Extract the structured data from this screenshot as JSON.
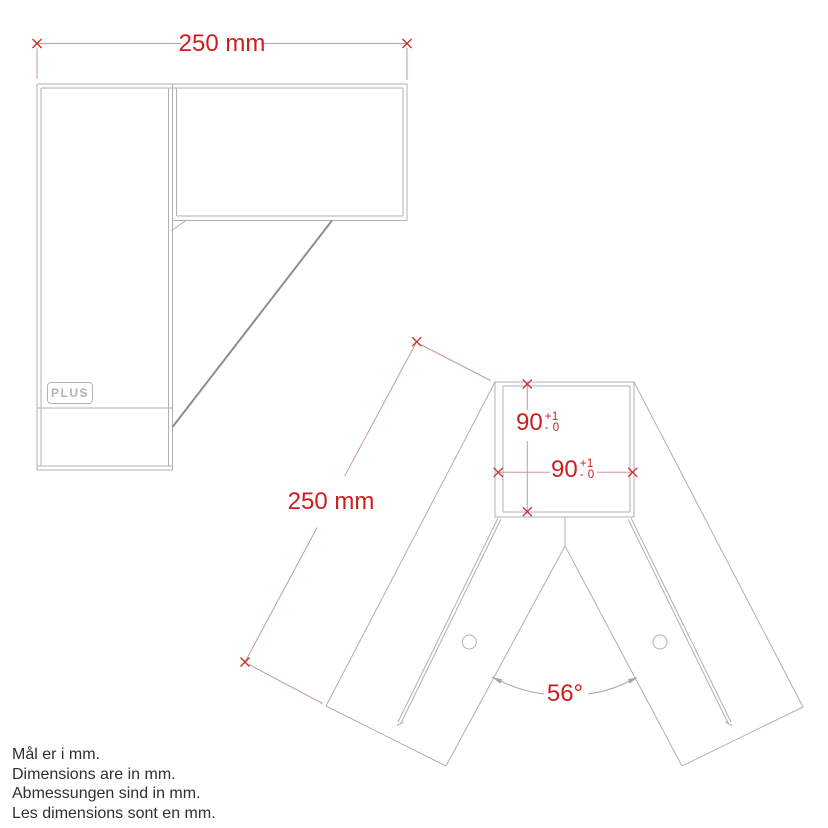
{
  "colors": {
    "dimension_text": "#cd1d1d",
    "dimension_line": "#c89a9a",
    "part_line": "#b0b0b0"
  },
  "side_view": {
    "width_dim": "250 mm"
  },
  "front_view": {
    "length_dim": "250 mm",
    "pocket_height": {
      "value": "90",
      "tol_top": "+1",
      "tol_bottom": "- 0"
    },
    "pocket_width": {
      "value": "90",
      "tol_top": "+1",
      "tol_bottom": "- 0"
    },
    "angle": "56°"
  },
  "logo": "PLUS",
  "notes": [
    "Mål er i mm.",
    "Dimensions are in mm.",
    "Abmessungen sind in mm.",
    "Les dimensions sont en mm."
  ]
}
